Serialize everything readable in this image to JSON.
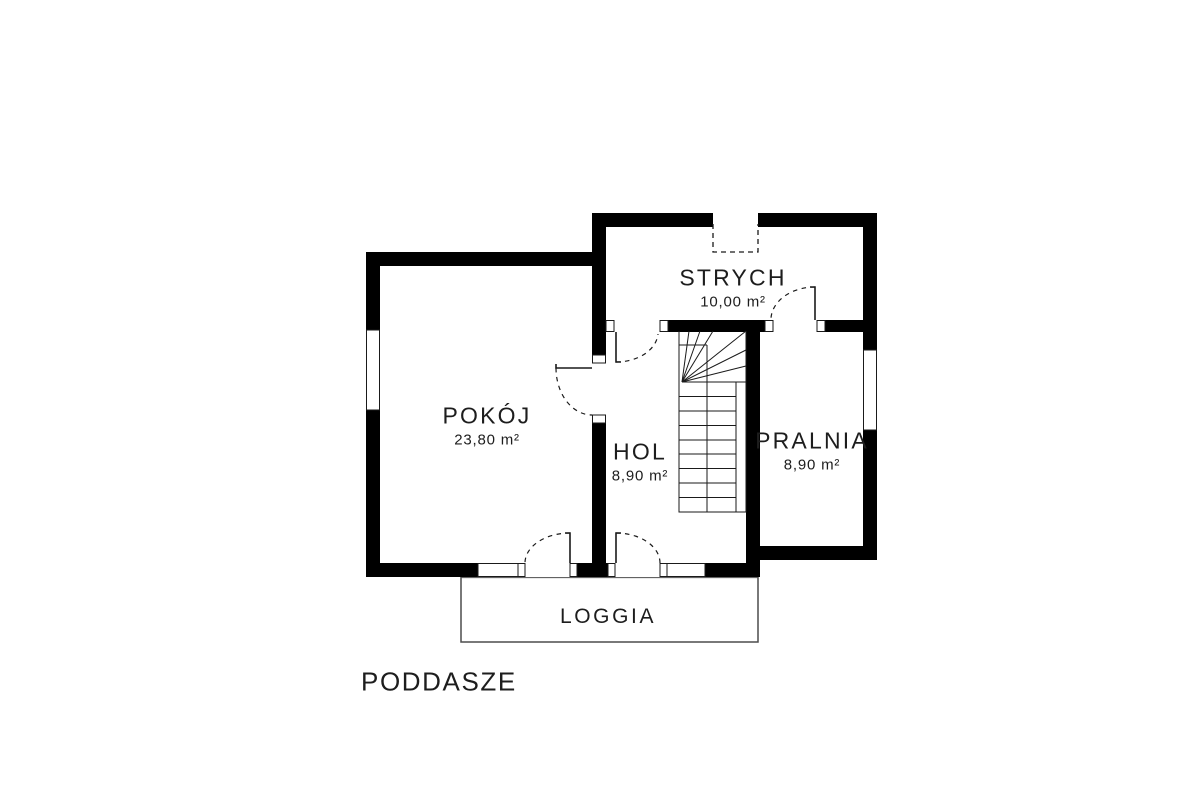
{
  "plan": {
    "title": "PODDASZE",
    "rooms": [
      {
        "name": "POKÓJ",
        "area": "23,80 m²"
      },
      {
        "name": "HOL",
        "area": "8,90 m²"
      },
      {
        "name": "STRYCH",
        "area": "10,00 m²"
      },
      {
        "name": "PRALNIA",
        "area": "8,90 m²"
      }
    ],
    "loggia": {
      "name": "LOGGIA"
    },
    "colors": {
      "wall": "#000000",
      "line": "#1a1a1a",
      "loggia_outline": "#4d4d4d",
      "text": "#1d1d1d",
      "background": "#ffffff"
    }
  }
}
